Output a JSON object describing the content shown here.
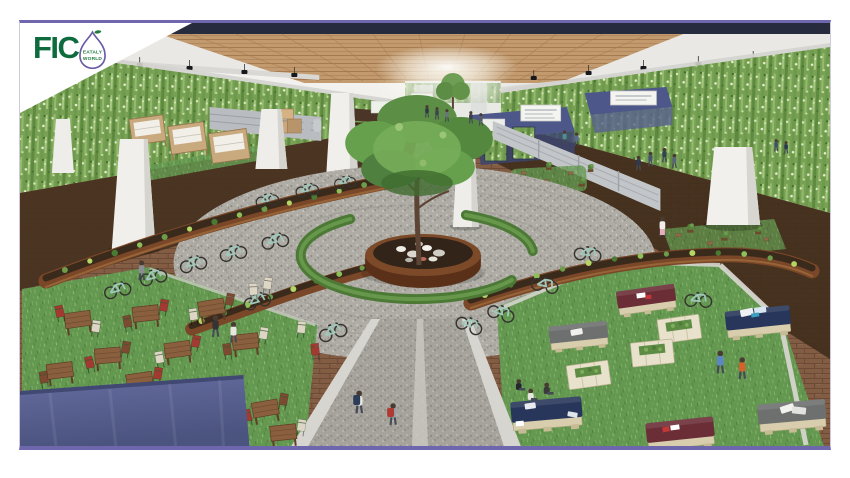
{
  "page": {
    "background_color": "#ffffff"
  },
  "frame": {
    "border_color": "#6f67ae",
    "side_border_color": "#cfcae0",
    "corner_flag_color": "#ffffff"
  },
  "logo": {
    "text": "FIC",
    "bulb_text_line1": "EATALY",
    "bulb_text_line2": "WORLD",
    "text_color": "#0e6b3d",
    "bulb_outline_color": "#6b5ca5",
    "leaf_color": "#1f7a3c"
  },
  "scene": {
    "palette": {
      "green_wall": "#79a156",
      "ceiling_wood": "#c29a6e",
      "ceiling_dark_band": "#262b3d",
      "ceiling_light": "#e9e8e4",
      "floor_brick": "#835c44",
      "floor_shadow": "#46321f",
      "gravel_plaza": "#aeaca5",
      "grass": "#649851",
      "corten_planter": "#7a4728",
      "soil": "#3a2a1b",
      "hedge_ring": "#4c7a36",
      "tree_canopy": "#5c9143",
      "tree_trunk": "#5c4534",
      "bicycle_mint": "#9fc8bb",
      "canopy_blue": "#5a6292",
      "pallet_navy": "#27365a",
      "pallet_maroon": "#6b2e37",
      "pallet_gray": "#6e706f",
      "crate_cream": "#e6dfca",
      "market_stall_navy": "#4d5789",
      "column_white": "#f0efeb"
    }
  }
}
